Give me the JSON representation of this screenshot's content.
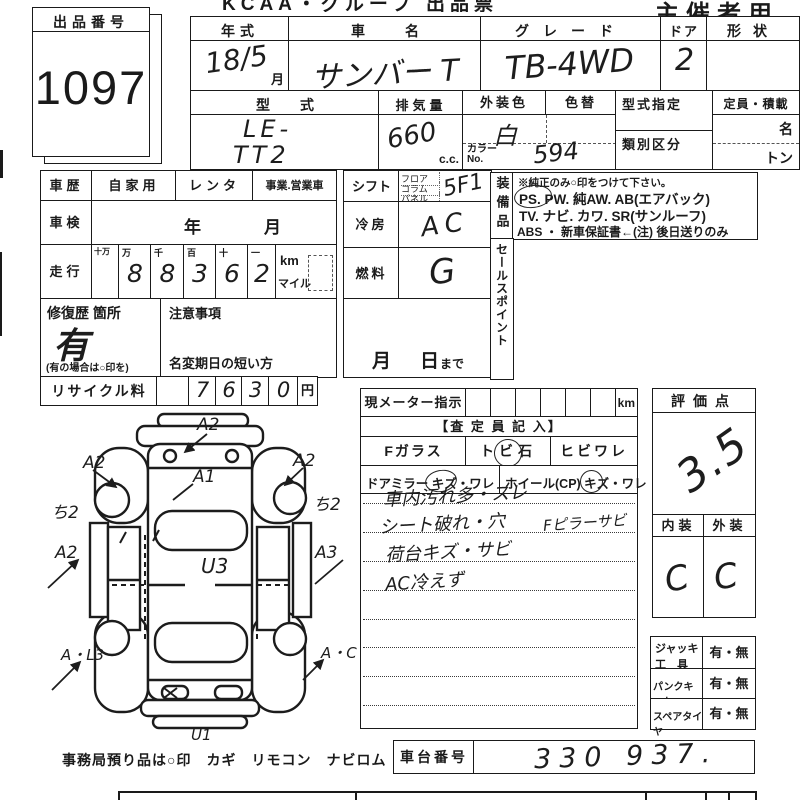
{
  "page": {
    "top_title": "KCAA・グループ 出品票",
    "owner_label": "主催者用",
    "footer": "事務局預り品は○印　カギ　リモコン　ナビロム"
  },
  "lot": {
    "label": "出品番号",
    "number": "1097"
  },
  "header": {
    "year": {
      "label": "年式",
      "value": "18/5",
      "unit": "月"
    },
    "name": {
      "label": "車名",
      "value": "サンバー T"
    },
    "grade": {
      "label": "グレード",
      "value": "TB-4WD"
    },
    "door": {
      "label": "ドア",
      "value": "2"
    },
    "shape": {
      "label": "形状",
      "value": ""
    },
    "model": {
      "label": "型式",
      "line1": "LE-",
      "line2": "TT2"
    },
    "disp": {
      "label": "排気量",
      "value": "660",
      "unit": "c.c."
    },
    "color": {
      "label": "外装色",
      "value": "白"
    },
    "color_change": {
      "label": "色替"
    },
    "color_no": {
      "label1": "カラー",
      "label2": "No.",
      "value": "594"
    },
    "designation": {
      "label": "型式指定"
    },
    "classification": {
      "label": "類別区分"
    },
    "capacity": {
      "label": "定員・積載",
      "persons": "名",
      "tons": "トン"
    }
  },
  "history": {
    "label": "車歴",
    "opt1": "自家用",
    "opt2": "レンタ",
    "opt3": "事業.営業車"
  },
  "inspection": {
    "label": "車検",
    "year": "年",
    "month": "月"
  },
  "mileage": {
    "label": "走行",
    "headers": [
      "十万",
      "万",
      "千",
      "百",
      "十",
      "一"
    ],
    "digits": [
      "",
      "8",
      "8",
      "3",
      "6",
      "2"
    ],
    "unit_km": "km",
    "unit_mile": "マイル"
  },
  "repair": {
    "label": "修復歴 箇所",
    "value": "有",
    "note": "(有の場合は○印を)"
  },
  "caution": {
    "label": "注意事項",
    "rename": "名変期日の短い方",
    "month": "月",
    "day": "日",
    "made": "まで"
  },
  "recycle": {
    "label": "リサイクル料",
    "digits": [
      "7",
      "6",
      "3",
      "0"
    ],
    "unit": "円"
  },
  "shift": {
    "label": "シフト",
    "opt1": "フロア",
    "opt2": "コラム",
    "opt3": "パネル",
    "value": "5F1"
  },
  "aircon": {
    "label": "冷房",
    "value": "AC"
  },
  "fuel": {
    "label": "燃料",
    "value": "G"
  },
  "equipment": {
    "label": "装備品",
    "note": "※純正のみ○印をつけて下さい。",
    "line1": "PS.  PW.  純AW.  AB(エアバック)",
    "line2": "TV.  ナビ.  カワ.  SR(サンルーフ)",
    "line3": "ABS ・ 新車保証書←(注) 後日送りのみ",
    "circled": "PS"
  },
  "sales": {
    "label": "セールスポイント"
  },
  "meter": {
    "label": "現メーター指示",
    "unit": "km"
  },
  "assessor": {
    "header": "【査 定 員 記 入】",
    "f_glass": "Fガラス",
    "stone": "トビ石",
    "crack": "ヒビワレ",
    "mirror": "ドアミラー キズ・ワレ",
    "wheel": "ホイール(CP) キズ・ワレ",
    "note1": "車内汚れ多・スレ",
    "note2": "シート破れ・穴",
    "note2b": "Fピラーサビ",
    "note3": "荷台キズ・サビ",
    "note4": "AC冷えず"
  },
  "evaluation": {
    "label": "評価点",
    "score": "3.5",
    "interior_label": "内装",
    "exterior_label": "外装",
    "interior": "C",
    "exterior": "C"
  },
  "tools": {
    "r1a": "ジャッキ",
    "r1b": "工　具",
    "r1v": "有・無",
    "r2": "パンクキット",
    "r2v": "有・無",
    "r3": "スペアタイヤ",
    "r3v": "有・無"
  },
  "chassis": {
    "label": "車台番号",
    "value": "330 937."
  },
  "diagram": {
    "marks": {
      "front_bumper": "A2",
      "hood": "A1",
      "front_left": "A2",
      "front_right": "A2",
      "left_side": "ち2",
      "right_side": "ち2",
      "mid_left": "A2",
      "mid_right": "A3",
      "center": "U3",
      "rear_left": "A・L3",
      "rear_right": "A・C",
      "rear": "U1"
    }
  },
  "colors": {
    "ink": "#1a1a1a",
    "paper": "#ffffff"
  }
}
